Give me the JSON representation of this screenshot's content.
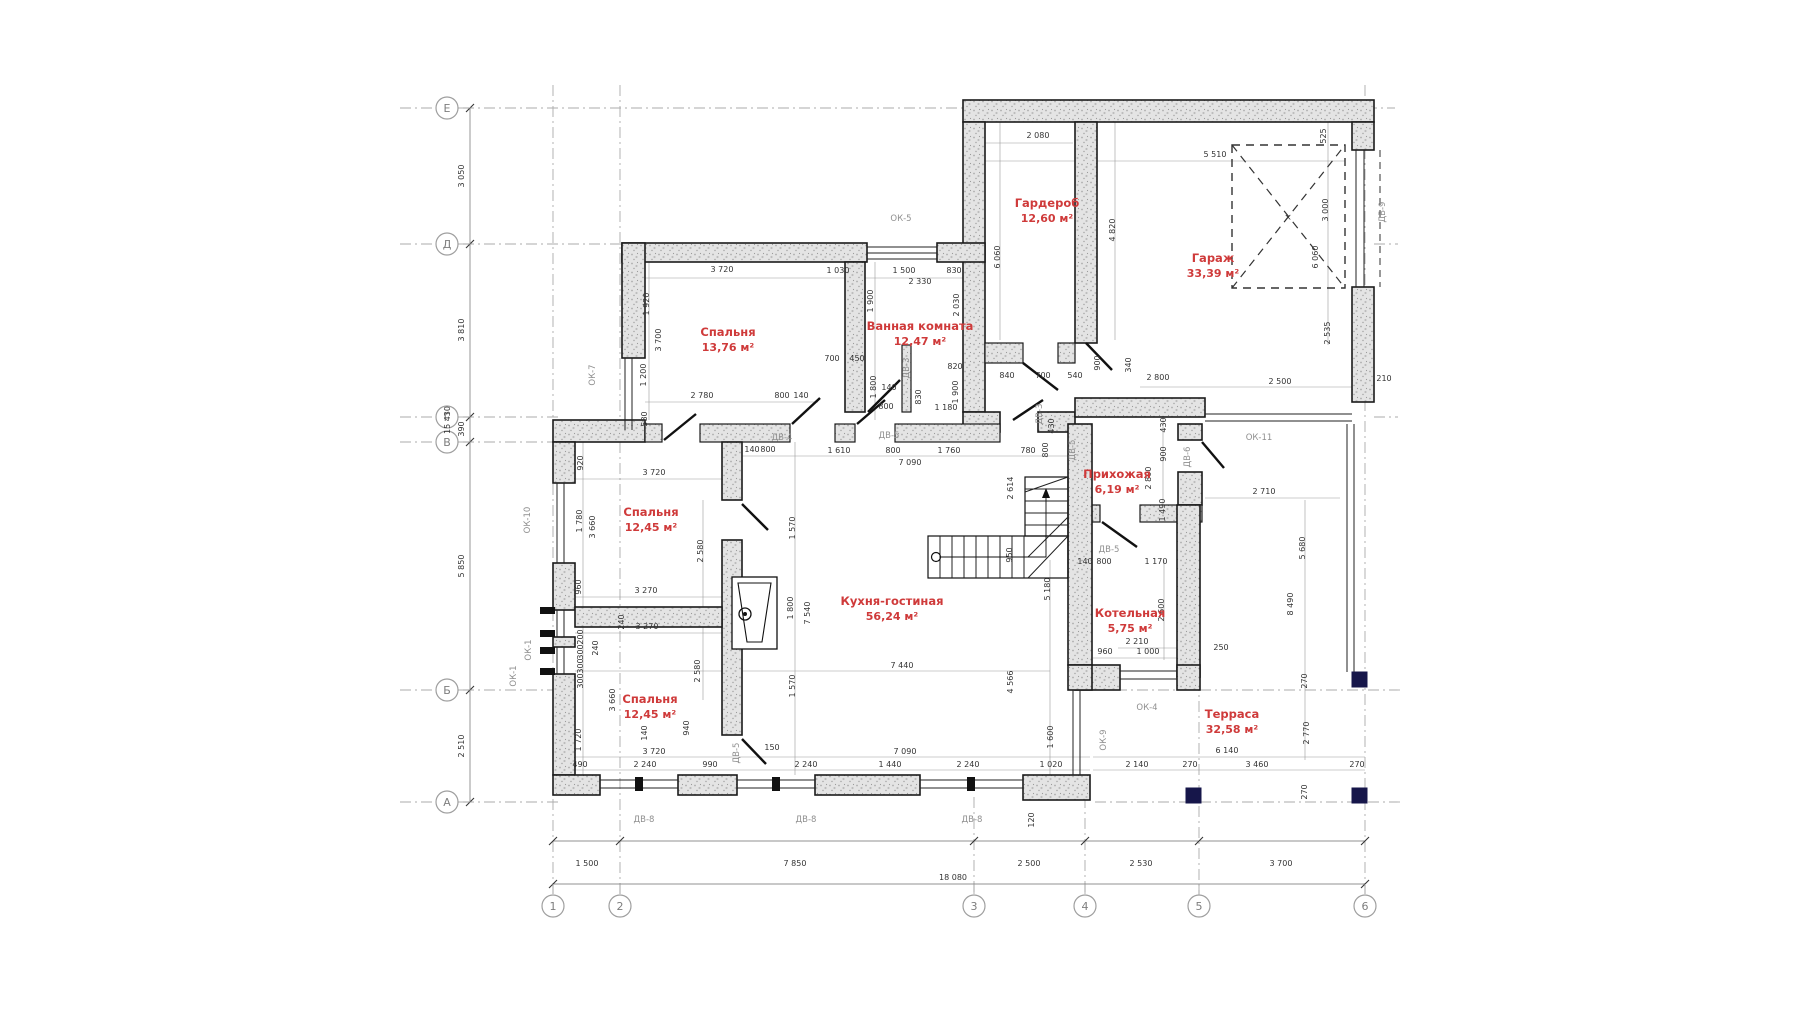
{
  "drawing": {
    "type": "floor-plan",
    "language": "ru",
    "colors": {
      "room_label": "#cf3a3a",
      "dim_text": "#333333",
      "opening_text": "#8f8f8f",
      "axis_text": "#7d7d7d",
      "wall_fill": "#e0e0e0",
      "column_fill": "#16164a"
    },
    "rooms": [
      {
        "name": "Спальня",
        "area": "13,76 м²",
        "x": 728,
        "y": 336
      },
      {
        "name": "Ванная комната",
        "area": "12,47 м²",
        "x": 920,
        "y": 330
      },
      {
        "name": "Гардероб",
        "area": "12,60 м²",
        "x": 1047,
        "y": 207
      },
      {
        "name": "Гараж",
        "area": "33,39 м²",
        "x": 1213,
        "y": 262
      },
      {
        "name": "Спальня",
        "area": "12,45 м²",
        "x": 651,
        "y": 516
      },
      {
        "name": "Кухня-гостиная",
        "area": "56,24 м²",
        "x": 892,
        "y": 605
      },
      {
        "name": "Прихожая",
        "area": "6,19 м²",
        "x": 1117,
        "y": 478
      },
      {
        "name": "Котельная",
        "area": "5,75 м²",
        "x": 1130,
        "y": 617
      },
      {
        "name": "Спальня",
        "area": "12,45 м²",
        "x": 650,
        "y": 703
      },
      {
        "name": "Терраса",
        "area": "32,58 м²",
        "x": 1232,
        "y": 718
      }
    ],
    "openings": [
      {
        "label": "ОК-5",
        "x": 901,
        "y": 221,
        "v": false
      },
      {
        "label": "ОК-7",
        "x": 595,
        "y": 375,
        "v": true
      },
      {
        "label": "ОК-10",
        "x": 530,
        "y": 520,
        "v": true
      },
      {
        "label": "ОК-1",
        "x": 531,
        "y": 650,
        "v": true
      },
      {
        "label": "ОК-1",
        "x": 516,
        "y": 676,
        "v": true
      },
      {
        "label": "ОК-11",
        "x": 1259,
        "y": 440,
        "v": false
      },
      {
        "label": "ОК-4",
        "x": 1147,
        "y": 710,
        "v": false
      },
      {
        "label": "ОК-9",
        "x": 1106,
        "y": 740,
        "v": true
      },
      {
        "label": "ДВ-4",
        "x": 782,
        "y": 440,
        "v": false
      },
      {
        "label": "ДВ-5",
        "x": 889,
        "y": 438,
        "v": false
      },
      {
        "label": "ДВ-3",
        "x": 909,
        "y": 368,
        "v": true
      },
      {
        "label": "ДВ-3",
        "x": 1042,
        "y": 414,
        "v": true
      },
      {
        "label": "ДВ-5",
        "x": 1075,
        "y": 450,
        "v": true
      },
      {
        "label": "ДВ-6",
        "x": 1190,
        "y": 457,
        "v": true
      },
      {
        "label": "ДВ-5",
        "x": 1109,
        "y": 552,
        "v": false
      },
      {
        "label": "ДВ-5",
        "x": 739,
        "y": 753,
        "v": true
      },
      {
        "label": "ДВ-8",
        "x": 644,
        "y": 822,
        "v": false
      },
      {
        "label": "ДВ-8",
        "x": 806,
        "y": 822,
        "v": false
      },
      {
        "label": "ДВ-8",
        "x": 972,
        "y": 822,
        "v": false
      },
      {
        "label": "ДВ-9",
        "x": 1385,
        "y": 212,
        "v": true
      }
    ],
    "axis_rows": [
      {
        "label": "Е",
        "y": 108
      },
      {
        "label": "Д",
        "y": 244
      },
      {
        "label": "Г",
        "y": 417
      },
      {
        "label": "В",
        "y": 442
      },
      {
        "label": "Б",
        "y": 690
      },
      {
        "label": "А",
        "y": 802
      }
    ],
    "axis_cols": [
      {
        "label": "1",
        "x": 553
      },
      {
        "label": "2",
        "x": 620
      },
      {
        "label": "3",
        "x": 974
      },
      {
        "label": "4",
        "x": 1085
      },
      {
        "label": "5",
        "x": 1199
      },
      {
        "label": "6",
        "x": 1365
      }
    ],
    "dims": [
      {
        "t": "1 500",
        "x": 587,
        "y": 866
      },
      {
        "t": "7 850",
        "x": 795,
        "y": 866
      },
      {
        "t": "2 500",
        "x": 1029,
        "y": 866
      },
      {
        "t": "2 530",
        "x": 1141,
        "y": 866
      },
      {
        "t": "3 700",
        "x": 1281,
        "y": 866
      },
      {
        "t": "18 080",
        "x": 953,
        "y": 880
      },
      {
        "t": "3 720",
        "x": 654,
        "y": 754
      },
      {
        "t": "150",
        "x": 772,
        "y": 750
      },
      {
        "t": "7 090",
        "x": 905,
        "y": 754
      },
      {
        "t": "6 140",
        "x": 1227,
        "y": 753
      },
      {
        "t": "490",
        "x": 580,
        "y": 767
      },
      {
        "t": "2 240",
        "x": 645,
        "y": 767
      },
      {
        "t": "990",
        "x": 710,
        "y": 767
      },
      {
        "t": "2 240",
        "x": 806,
        "y": 767
      },
      {
        "t": "1 440",
        "x": 890,
        "y": 767
      },
      {
        "t": "2 240",
        "x": 968,
        "y": 767
      },
      {
        "t": "1 020",
        "x": 1051,
        "y": 767
      },
      {
        "t": "2 140",
        "x": 1137,
        "y": 767
      },
      {
        "t": "270",
        "x": 1190,
        "y": 767
      },
      {
        "t": "3 460",
        "x": 1257,
        "y": 767
      },
      {
        "t": "270",
        "x": 1357,
        "y": 767
      },
      {
        "t": "120",
        "x": 1034,
        "y": 820,
        "v": 1
      },
      {
        "t": "3 050",
        "x": 464,
        "y": 176,
        "v": 1
      },
      {
        "t": "3 810",
        "x": 464,
        "y": 330,
        "v": 1
      },
      {
        "t": "390",
        "x": 464,
        "y": 429,
        "v": 1
      },
      {
        "t": "5 850",
        "x": 464,
        "y": 566,
        "v": 1
      },
      {
        "t": "2 510",
        "x": 464,
        "y": 746,
        "v": 1
      },
      {
        "t": "15 430",
        "x": 450,
        "y": 420,
        "v": 1
      },
      {
        "t": "3 720",
        "x": 722,
        "y": 272
      },
      {
        "t": "1 920",
        "x": 649,
        "y": 304,
        "v": 1
      },
      {
        "t": "3 700",
        "x": 661,
        "y": 340,
        "v": 1
      },
      {
        "t": "1 200",
        "x": 646,
        "y": 375,
        "v": 1
      },
      {
        "t": "580",
        "x": 647,
        "y": 419,
        "v": 1
      },
      {
        "t": "2 780",
        "x": 702,
        "y": 398
      },
      {
        "t": "800",
        "x": 782,
        "y": 398
      },
      {
        "t": "140",
        "x": 801,
        "y": 398
      },
      {
        "t": "1 030",
        "x": 838,
        "y": 273
      },
      {
        "t": "1 500",
        "x": 904,
        "y": 273
      },
      {
        "t": "830",
        "x": 954,
        "y": 273
      },
      {
        "t": "2 330",
        "x": 920,
        "y": 284
      },
      {
        "t": "1 900",
        "x": 873,
        "y": 301,
        "v": 1
      },
      {
        "t": "2 030",
        "x": 959,
        "y": 305,
        "v": 1
      },
      {
        "t": "700",
        "x": 832,
        "y": 361
      },
      {
        "t": "450",
        "x": 857,
        "y": 361
      },
      {
        "t": "820",
        "x": 955,
        "y": 369
      },
      {
        "t": "1 800",
        "x": 876,
        "y": 387,
        "v": 1
      },
      {
        "t": "140",
        "x": 889,
        "y": 390
      },
      {
        "t": "1 900",
        "x": 958,
        "y": 392,
        "v": 1
      },
      {
        "t": "830",
        "x": 921,
        "y": 397,
        "v": 1
      },
      {
        "t": "800",
        "x": 886,
        "y": 409
      },
      {
        "t": "1 180",
        "x": 946,
        "y": 410
      },
      {
        "t": "2 080",
        "x": 1038,
        "y": 138
      },
      {
        "t": "6 060",
        "x": 1000,
        "y": 257,
        "v": 1
      },
      {
        "t": "4 820",
        "x": 1115,
        "y": 230,
        "v": 1
      },
      {
        "t": "5 510",
        "x": 1215,
        "y": 157
      },
      {
        "t": "525",
        "x": 1326,
        "y": 136,
        "v": 1
      },
      {
        "t": "3 000",
        "x": 1328,
        "y": 210,
        "v": 1
      },
      {
        "t": "6 060",
        "x": 1318,
        "y": 257,
        "v": 1
      },
      {
        "t": "2 535",
        "x": 1330,
        "y": 333,
        "v": 1
      },
      {
        "t": "900",
        "x": 1100,
        "y": 363,
        "v": 1
      },
      {
        "t": "340",
        "x": 1131,
        "y": 365,
        "v": 1
      },
      {
        "t": "840",
        "x": 1007,
        "y": 378
      },
      {
        "t": "700",
        "x": 1043,
        "y": 378
      },
      {
        "t": "540",
        "x": 1075,
        "y": 378
      },
      {
        "t": "2 800",
        "x": 1158,
        "y": 380
      },
      {
        "t": "2 500",
        "x": 1280,
        "y": 384
      },
      {
        "t": "210",
        "x": 1384,
        "y": 381
      },
      {
        "t": "140",
        "x": 752,
        "y": 452
      },
      {
        "t": "800",
        "x": 768,
        "y": 452
      },
      {
        "t": "1 610",
        "x": 839,
        "y": 453
      },
      {
        "t": "800",
        "x": 893,
        "y": 453
      },
      {
        "t": "1 760",
        "x": 949,
        "y": 453
      },
      {
        "t": "780",
        "x": 1028,
        "y": 453
      },
      {
        "t": "7 090",
        "x": 910,
        "y": 465
      },
      {
        "t": "430",
        "x": 1054,
        "y": 426,
        "v": 1
      },
      {
        "t": "800",
        "x": 1048,
        "y": 450,
        "v": 1
      },
      {
        "t": "2 614",
        "x": 1013,
        "y": 488,
        "v": 1
      },
      {
        "t": "430",
        "x": 1166,
        "y": 425,
        "v": 1
      },
      {
        "t": "900",
        "x": 1166,
        "y": 454,
        "v": 1
      },
      {
        "t": "2 800",
        "x": 1151,
        "y": 478,
        "v": 1
      },
      {
        "t": "1 490",
        "x": 1165,
        "y": 510,
        "v": 1
      },
      {
        "t": "140",
        "x": 1085,
        "y": 564
      },
      {
        "t": "800",
        "x": 1104,
        "y": 564
      },
      {
        "t": "1 170",
        "x": 1156,
        "y": 564
      },
      {
        "t": "2 710",
        "x": 1264,
        "y": 494
      },
      {
        "t": "5 680",
        "x": 1305,
        "y": 548,
        "v": 1
      },
      {
        "t": "8 490",
        "x": 1293,
        "y": 604,
        "v": 1
      },
      {
        "t": "2 600",
        "x": 1164,
        "y": 610,
        "v": 1
      },
      {
        "t": "2 210",
        "x": 1137,
        "y": 644
      },
      {
        "t": "960",
        "x": 1105,
        "y": 654
      },
      {
        "t": "1 000",
        "x": 1148,
        "y": 654
      },
      {
        "t": "250",
        "x": 1221,
        "y": 650
      },
      {
        "t": "2 770",
        "x": 1309,
        "y": 733,
        "v": 1
      },
      {
        "t": "270",
        "x": 1307,
        "y": 681,
        "v": 1
      },
      {
        "t": "270",
        "x": 1307,
        "y": 792,
        "v": 1
      },
      {
        "t": "1 570",
        "x": 795,
        "y": 528,
        "v": 1
      },
      {
        "t": "1 800",
        "x": 793,
        "y": 608,
        "v": 1
      },
      {
        "t": "7 540",
        "x": 810,
        "y": 613,
        "v": 1
      },
      {
        "t": "7 440",
        "x": 902,
        "y": 668
      },
      {
        "t": "1 570",
        "x": 795,
        "y": 686,
        "v": 1
      },
      {
        "t": "950",
        "x": 1012,
        "y": 555,
        "v": 1
      },
      {
        "t": "5 180",
        "x": 1050,
        "y": 589,
        "v": 1
      },
      {
        "t": "4 566",
        "x": 1013,
        "y": 682,
        "v": 1
      },
      {
        "t": "1 600",
        "x": 1053,
        "y": 737,
        "v": 1
      },
      {
        "t": "920",
        "x": 583,
        "y": 463,
        "v": 1
      },
      {
        "t": "3 720",
        "x": 654,
        "y": 475
      },
      {
        "t": "1 780",
        "x": 582,
        "y": 521,
        "v": 1
      },
      {
        "t": "3 660",
        "x": 595,
        "y": 527,
        "v": 1
      },
      {
        "t": "2 580",
        "x": 703,
        "y": 551,
        "v": 1
      },
      {
        "t": "960",
        "x": 581,
        "y": 587,
        "v": 1
      },
      {
        "t": "3 270",
        "x": 646,
        "y": 593
      },
      {
        "t": "3 270",
        "x": 647,
        "y": 629
      },
      {
        "t": "240",
        "x": 624,
        "y": 622,
        "v": 1
      },
      {
        "t": "2 580",
        "x": 700,
        "y": 671,
        "v": 1
      },
      {
        "t": "200",
        "x": 583,
        "y": 637,
        "v": 1
      },
      {
        "t": "300",
        "x": 583,
        "y": 652,
        "v": 1
      },
      {
        "t": "300",
        "x": 583,
        "y": 666,
        "v": 1
      },
      {
        "t": "300",
        "x": 583,
        "y": 681,
        "v": 1
      },
      {
        "t": "240",
        "x": 598,
        "y": 648,
        "v": 1
      },
      {
        "t": "3 660",
        "x": 615,
        "y": 700,
        "v": 1
      },
      {
        "t": "1 720",
        "x": 581,
        "y": 740,
        "v": 1
      },
      {
        "t": "140",
        "x": 647,
        "y": 733,
        "v": 1
      },
      {
        "t": "940",
        "x": 689,
        "y": 728,
        "v": 1
      }
    ]
  }
}
